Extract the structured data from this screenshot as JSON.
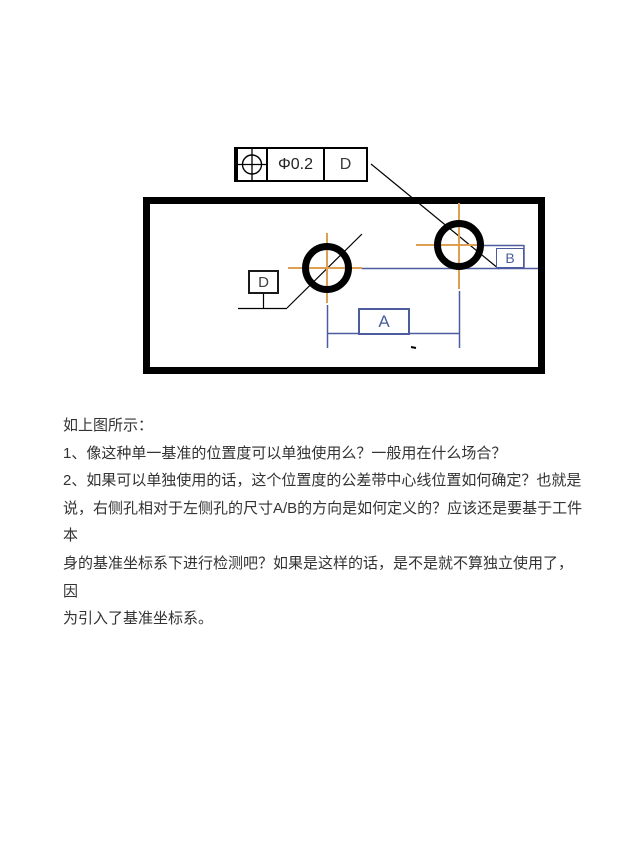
{
  "drawing": {
    "feature_control_frame": {
      "symbol_name": "position-tolerance-icon",
      "symbol_glyph": "⌖",
      "tolerance": "Φ0.2",
      "datum": "D"
    },
    "labels": {
      "datum_box": "D",
      "dim_horizontal": "A",
      "dim_vertical": "B"
    },
    "colors": {
      "outline_black": "#000000",
      "dimension_blue": "#4d5c9e",
      "crosshair_orange": "#dda052"
    }
  },
  "question": {
    "lines": [
      "如上图所示：",
      "1、像这种单一基准的位置度可以单独使用么？一般用在什么场合？",
      "2、如果可以单独使用的话，这个位置度的公差带中心线位置如何确定？也就是",
      "说，右侧孔相对于左侧孔的尺寸A/B的方向是如何定义的？应该还是要基于工件本",
      "身的基准坐标系下进行检测吧？如果是这样的话，是不是就不算独立使用了，因",
      "为引入了基准坐标系。"
    ]
  }
}
